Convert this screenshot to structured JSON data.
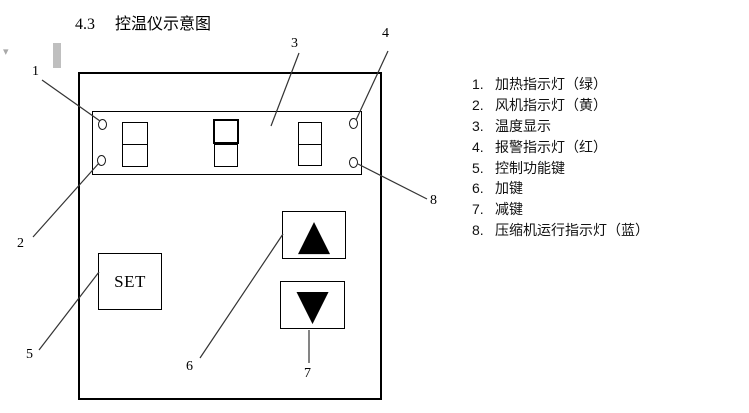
{
  "heading": {
    "number": "4.3",
    "title": "控温仪示意图"
  },
  "panel": {
    "set_label": "SET"
  },
  "icons": {
    "up_arrow": "▲",
    "down_arrow": "▼",
    "margin_caret": "▾"
  },
  "callouts": [
    "1",
    "2",
    "3",
    "4",
    "5",
    "6",
    "7",
    "8"
  ],
  "legend": [
    {
      "num": "1.",
      "label": "加热指示灯（绿）"
    },
    {
      "num": "2.",
      "label": "风机指示灯（黄）"
    },
    {
      "num": "3.",
      "label": "温度显示"
    },
    {
      "num": "4.",
      "label": "报警指示灯（红）"
    },
    {
      "num": "5.",
      "label": "控制功能键"
    },
    {
      "num": "6.",
      "label": "加键"
    },
    {
      "num": "7.",
      "label": "减键"
    },
    {
      "num": "8.",
      "label": "压缩机运行指示灯（蓝）"
    }
  ],
  "colors": {
    "border": "#000000",
    "leader_line": "#333333",
    "artifact_gray": "#bfbfbf",
    "background": "#ffffff"
  }
}
